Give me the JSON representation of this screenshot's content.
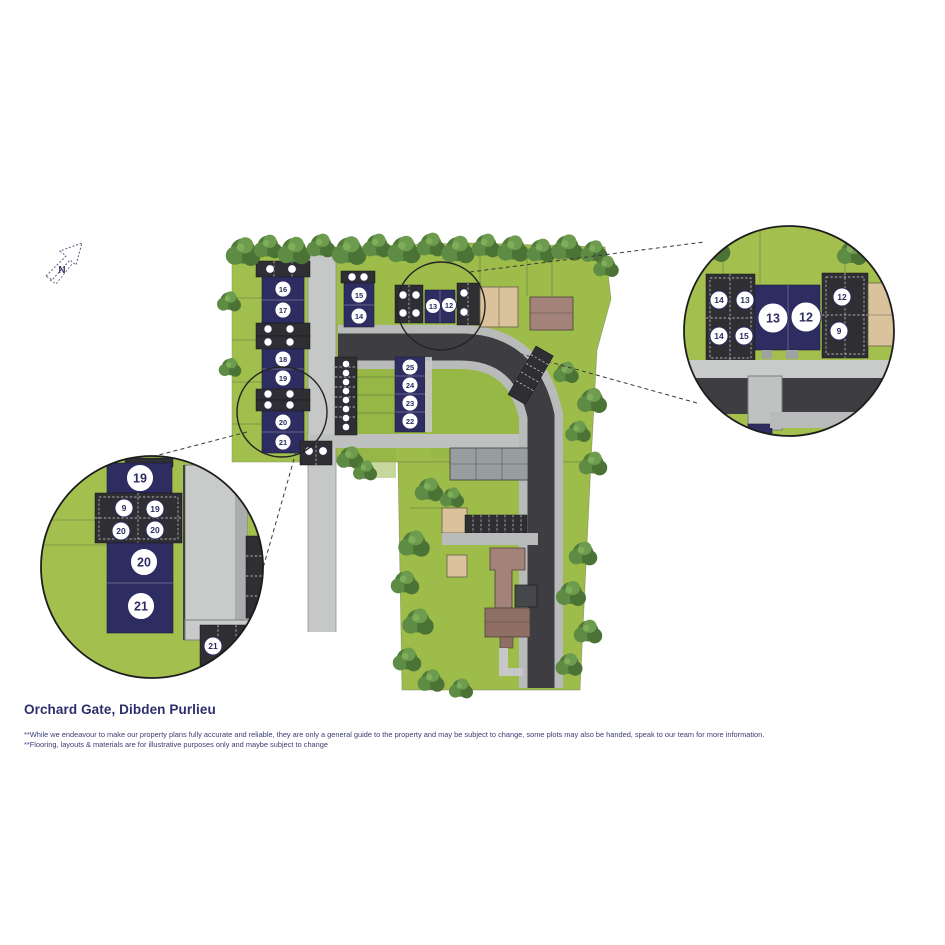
{
  "title": "Orchard Gate, Dibden Purlieu",
  "disclaimer_line1": "**While we endeavour to make our property plans fully accurate and reliable, they are only a general guide to the property and may be subject to change, some plots may also be handed, speak to our team for more information.",
  "disclaimer_line2": "**Flooring, layouts & materials are for illustrative purposes only and maybe subject to change",
  "north": "N",
  "plan": {
    "plots_left": [
      "16",
      "17",
      "18",
      "19",
      "20",
      "21"
    ],
    "plots_mid_top": [
      "15",
      "14"
    ],
    "plots_circled": [
      "13",
      "12"
    ],
    "plots_mid": [
      "25",
      "24",
      "23",
      "22"
    ]
  },
  "callout_left": {
    "plot_top": "19",
    "plot_mid": "20",
    "plot_bottom": "21",
    "parking": [
      "9",
      "19",
      "20",
      "20"
    ],
    "parking_bottom": "21"
  },
  "callout_right": {
    "plot_left": "13",
    "plot_right": "12",
    "parking_left": [
      "14",
      "13",
      "14",
      "15"
    ],
    "parking_right": [
      "12",
      "9"
    ]
  },
  "colors": {
    "accent_navy": "#2e2d62",
    "grass": "#9dbc4a",
    "tree": "#527d3a",
    "road": "#3e3e42",
    "path_gray": "#c6c8c7",
    "parking": "#2e2e33",
    "tan_building": "#d9c29c",
    "brown_building": "#a3827a",
    "gray_building": "#989da0",
    "text_navy": "#2c2f6b"
  }
}
